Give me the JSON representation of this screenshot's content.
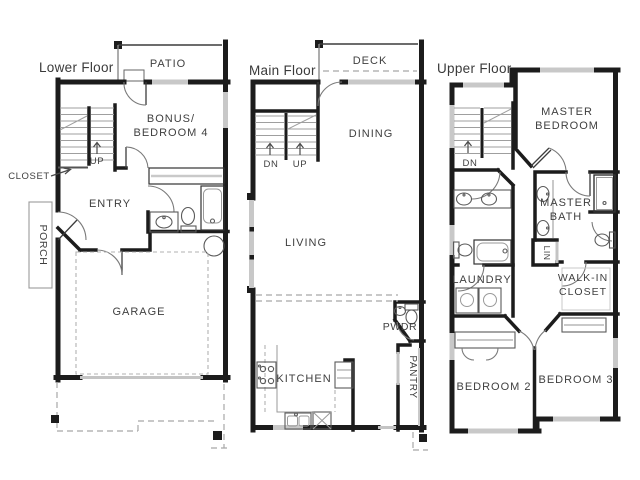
{
  "palette": {
    "background": "#ffffff",
    "wall": "#1c1c1c",
    "window_gray": "#c8c8c8",
    "fixture_gray": "#9a9a9a",
    "dashed_gray": "#a8a8a8",
    "text": "#3f3f3f"
  },
  "floors": [
    {
      "label": "Lower Floor",
      "rooms": {
        "patio": "PATIO",
        "bonus_line1": "BONUS/",
        "bonus_line2": "BEDROOM 4",
        "entry": "ENTRY",
        "porch": "PORCH",
        "garage": "GARAGE"
      },
      "annotations": {
        "closet": "CLOSET",
        "up": "UP"
      }
    },
    {
      "label": "Main Floor",
      "rooms": {
        "deck": "DECK",
        "dining": "DINING",
        "living": "LIVING",
        "kitchen": "KITCHEN",
        "powder": "PWDR",
        "pantry": "PANTRY"
      },
      "annotations": {
        "dn": "DN",
        "up": "UP"
      }
    },
    {
      "label": "Upper Floor",
      "rooms": {
        "master_bedroom_line1": "MASTER",
        "master_bedroom_line2": "BEDROOM",
        "master_bath_line1": "MASTER",
        "master_bath_line2": "BATH",
        "laundry": "LAUNDRY",
        "linen": "LIN",
        "walkin_line1": "WALK-IN",
        "walkin_line2": "CLOSET",
        "bedroom2": "BEDROOM 2",
        "bedroom3": "BEDROOM 3"
      },
      "annotations": {
        "dn": "DN"
      }
    }
  ]
}
